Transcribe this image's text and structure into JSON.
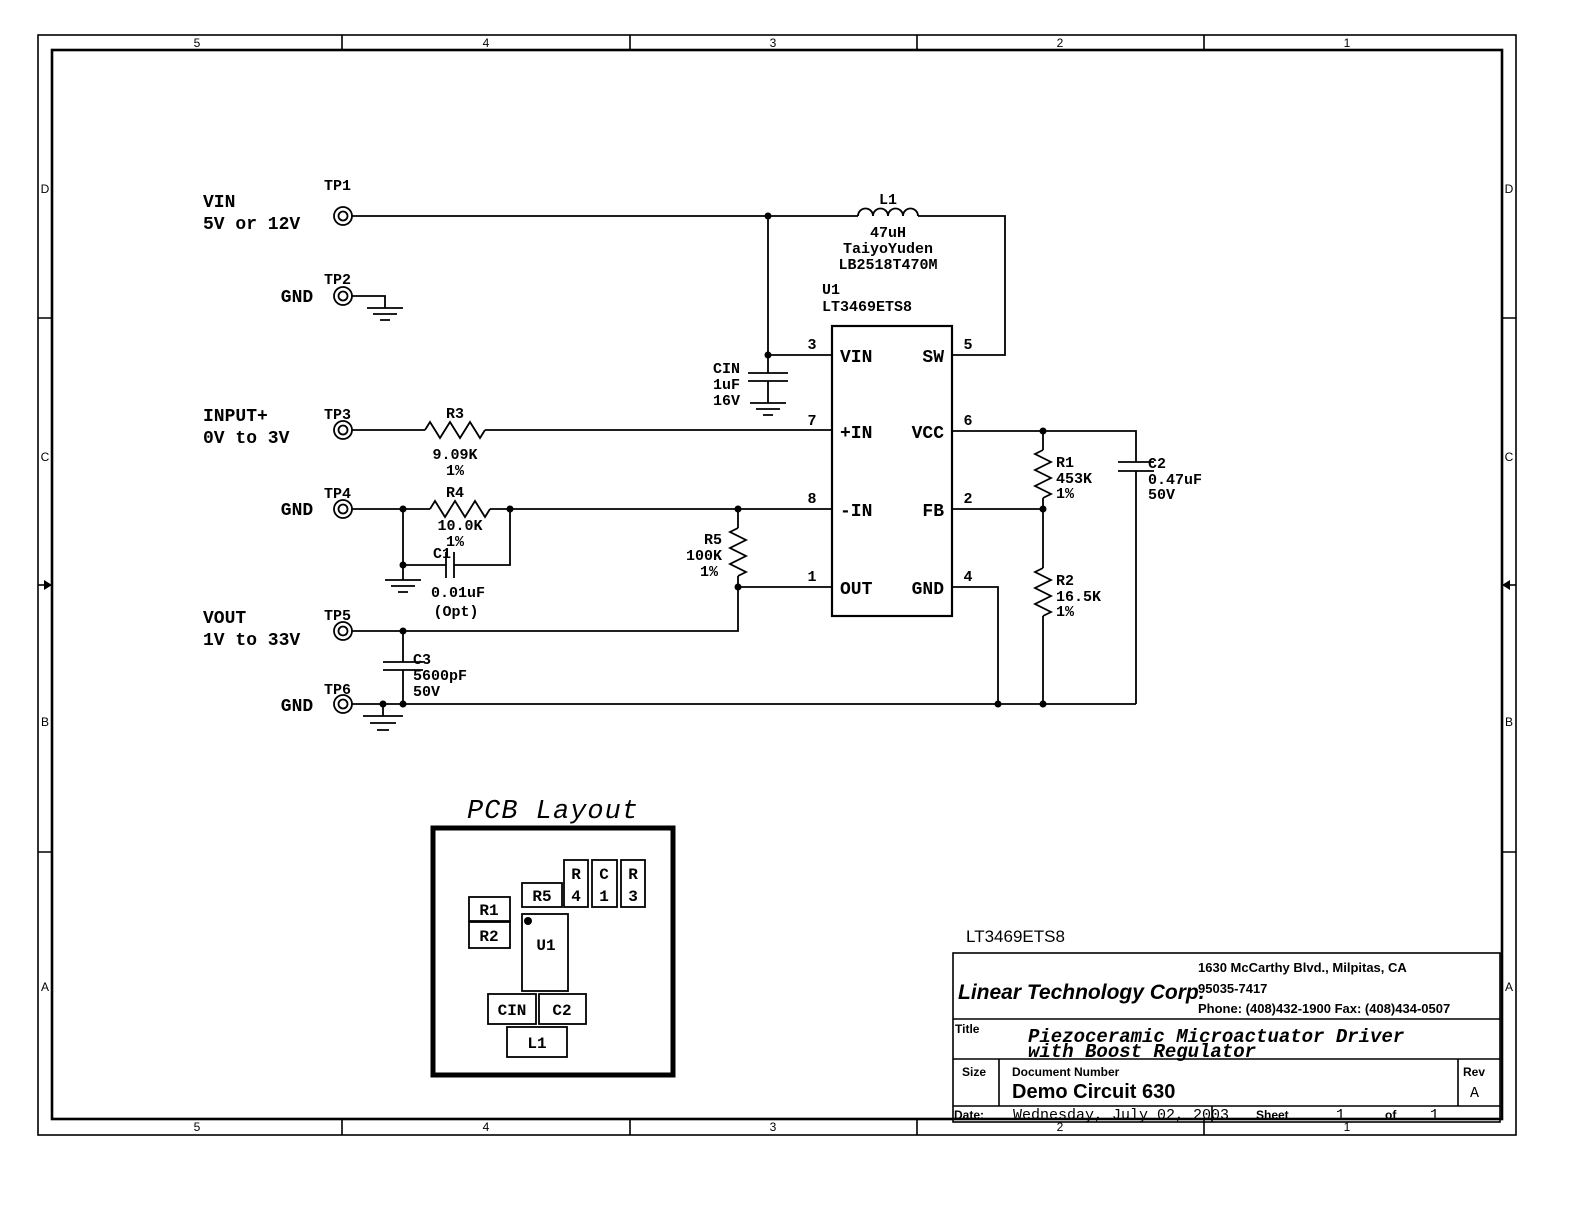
{
  "frame": {
    "cols": [
      "5",
      "4",
      "3",
      "2",
      "1"
    ],
    "rows": [
      "D",
      "C",
      "B",
      "A"
    ]
  },
  "nets": {
    "vin": {
      "label": "VIN",
      "range": "5V or 12V",
      "tp": "TP1"
    },
    "gnd_in": {
      "label": "GND",
      "tp": "TP2"
    },
    "input": {
      "label": "INPUT+",
      "range": "0V to 3V",
      "tp": "TP3"
    },
    "gnd_mid": {
      "label": "GND",
      "tp": "TP4"
    },
    "vout": {
      "label": "VOUT",
      "range": "1V to 33V",
      "tp": "TP5"
    },
    "gnd_out": {
      "label": "GND",
      "tp": "TP6"
    }
  },
  "parts": {
    "l1": {
      "ref": "L1",
      "value": "47uH",
      "mfr": "TaiyoYuden",
      "pn": "LB2518T470M"
    },
    "cin": {
      "ref": "CIN",
      "value": "1uF",
      "volt": "16V"
    },
    "r3": {
      "ref": "R3",
      "value": "9.09K",
      "tol": "1%"
    },
    "r4": {
      "ref": "R4",
      "value": "10.0K",
      "tol": "1%"
    },
    "c1": {
      "ref": "C1",
      "value": "0.01uF",
      "note": "(Opt)"
    },
    "r5": {
      "ref": "R5",
      "value": "100K",
      "tol": "1%"
    },
    "r1": {
      "ref": "R1",
      "value": "453K",
      "tol": "1%"
    },
    "r2": {
      "ref": "R2",
      "value": "16.5K",
      "tol": "1%"
    },
    "c2": {
      "ref": "C2",
      "value": "0.47uF",
      "volt": "50V"
    },
    "c3": {
      "ref": "C3",
      "value": "5600pF",
      "volt": "50V"
    }
  },
  "ic": {
    "ref": "U1",
    "part": "LT3469ETS8",
    "pins": {
      "p3": {
        "num": "3",
        "name": "VIN"
      },
      "p5": {
        "num": "5",
        "name": "SW"
      },
      "p7": {
        "num": "7",
        "name": "+IN"
      },
      "p6": {
        "num": "6",
        "name": "VCC"
      },
      "p8": {
        "num": "8",
        "name": "-IN"
      },
      "p2": {
        "num": "2",
        "name": "FB"
      },
      "p1": {
        "num": "1",
        "name": "OUT"
      },
      "p4": {
        "num": "4",
        "name": "GND"
      }
    }
  },
  "pcb": {
    "title": "PCB Layout",
    "r5": "R5",
    "r1": "R1",
    "r2": "R2",
    "u1": "U1",
    "cin": "CIN",
    "c2": "C2",
    "l1": "L1",
    "r4": {
      "l1": "R",
      "l2": "4"
    },
    "c1": {
      "l1": "C",
      "l2": "1"
    },
    "r3": {
      "l1": "R",
      "l2": "3"
    }
  },
  "tb": {
    "part": "LT3469ETS8",
    "company": "Linear Technology Corp.",
    "address1": "1630 McCarthy Blvd., Milpitas, CA",
    "address2": "95035-7417",
    "address3": "Phone: (408)432-1900 Fax: (408)434-0507",
    "title_label": "Title",
    "title1": "Piezoceramic Microactuator Driver",
    "title2": "with Boost Regulator",
    "size_label": "Size",
    "doc_label": "Document Number",
    "doc": "Demo Circuit 630",
    "rev_label": "Rev",
    "rev": "A",
    "date_label": "Date:",
    "date": "Wednesday, July 02, 2003",
    "sheet_label": "Sheet",
    "sheet_num": "1",
    "of_label": "of",
    "sheet_total": "1"
  }
}
